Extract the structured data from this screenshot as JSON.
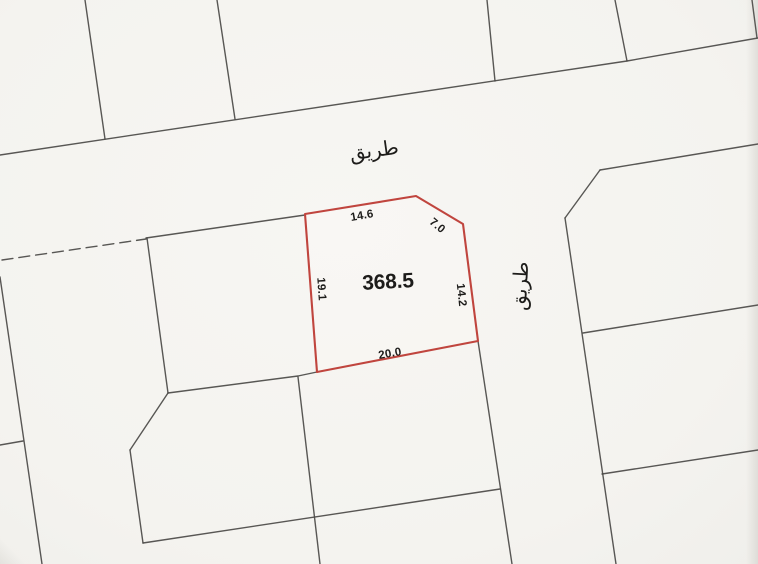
{
  "map": {
    "type": "cadastral-plot-map",
    "background_color": "#f5f4f1",
    "parcel_line_color": "#4a4946",
    "highlight_color": "#c0453e",
    "label_color": "#1d1c1a",
    "horizontal_road": {
      "label": "طريق"
    },
    "vertical_road": {
      "label": "طريق"
    },
    "highlighted_plot": {
      "area": "368.5",
      "dimensions": {
        "top": "14.6",
        "corner_cut": "7.0",
        "right": "14.2",
        "bottom": "20.0",
        "left": "19.1"
      }
    }
  }
}
